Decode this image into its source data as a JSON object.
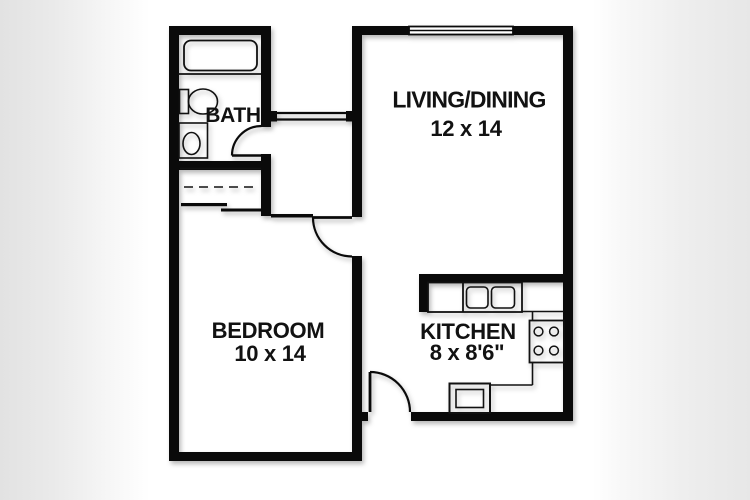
{
  "title": "One-bedroom apartment floor plan",
  "colors": {
    "background_band": "#e6e6e6",
    "plan_background": "#ffffff",
    "wall": "#0a0a0a",
    "text": "#121212"
  },
  "rooms": {
    "bath": {
      "label": "BATH"
    },
    "living_dining": {
      "label": "LIVING/DINING",
      "dimensions": "12 x 14"
    },
    "bedroom": {
      "label": "BEDROOM",
      "dimensions": "10 x 14"
    },
    "kitchen": {
      "label": "KITCHEN",
      "dimensions": "8 x 8'6\""
    }
  },
  "fixtures": [
    "bathtub",
    "toilet",
    "bathroom-sink",
    "closet-sliding-doors",
    "kitchen-counter",
    "double-sink",
    "stove-four-burners",
    "oven",
    "entry-door",
    "bedroom-door",
    "bath-door",
    "window-living-top",
    "window-hall-passthrough"
  ]
}
